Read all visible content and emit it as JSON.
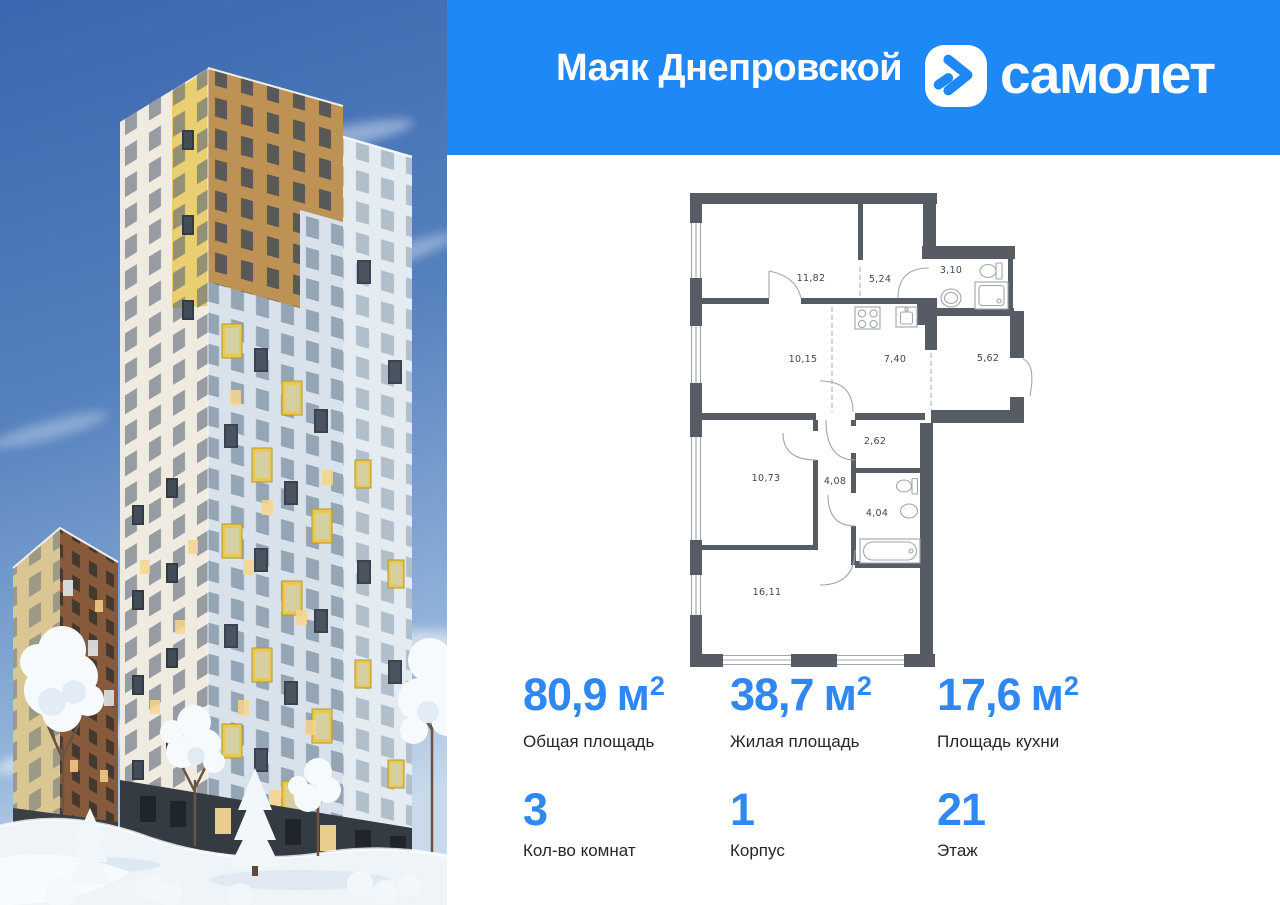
{
  "header": {
    "project_title": "Маяк Днепровской",
    "brand": "самолет",
    "logo_icon": "samolet-arrow-icon",
    "accent_blue": "#1E88F7"
  },
  "floor_plan": {
    "wall_color": "#575C64",
    "rooms": [
      {
        "area": "11,82"
      },
      {
        "area": "5,24"
      },
      {
        "area": "3,10"
      },
      {
        "area": "10,15"
      },
      {
        "area": "7,40"
      },
      {
        "area": "5,62"
      },
      {
        "area": "2,62"
      },
      {
        "area": "10,73"
      },
      {
        "area": "4,08"
      },
      {
        "area": "4,04"
      },
      {
        "area": "16,11"
      }
    ]
  },
  "stats": {
    "value_color": "#2F87F1",
    "row1": [
      {
        "value": "80,9",
        "unit": "м",
        "sup": "2",
        "label": "Общая площадь"
      },
      {
        "value": "38,7",
        "unit": "м",
        "sup": "2",
        "label": "Жилая площадь"
      },
      {
        "value": "17,6",
        "unit": "м",
        "sup": "2",
        "label": "Площадь кухни"
      }
    ],
    "row2": [
      {
        "value": "3",
        "label": "Кол-во комнат"
      },
      {
        "value": "1",
        "label": "Корпус"
      },
      {
        "value": "21",
        "label": "Этаж"
      }
    ]
  }
}
